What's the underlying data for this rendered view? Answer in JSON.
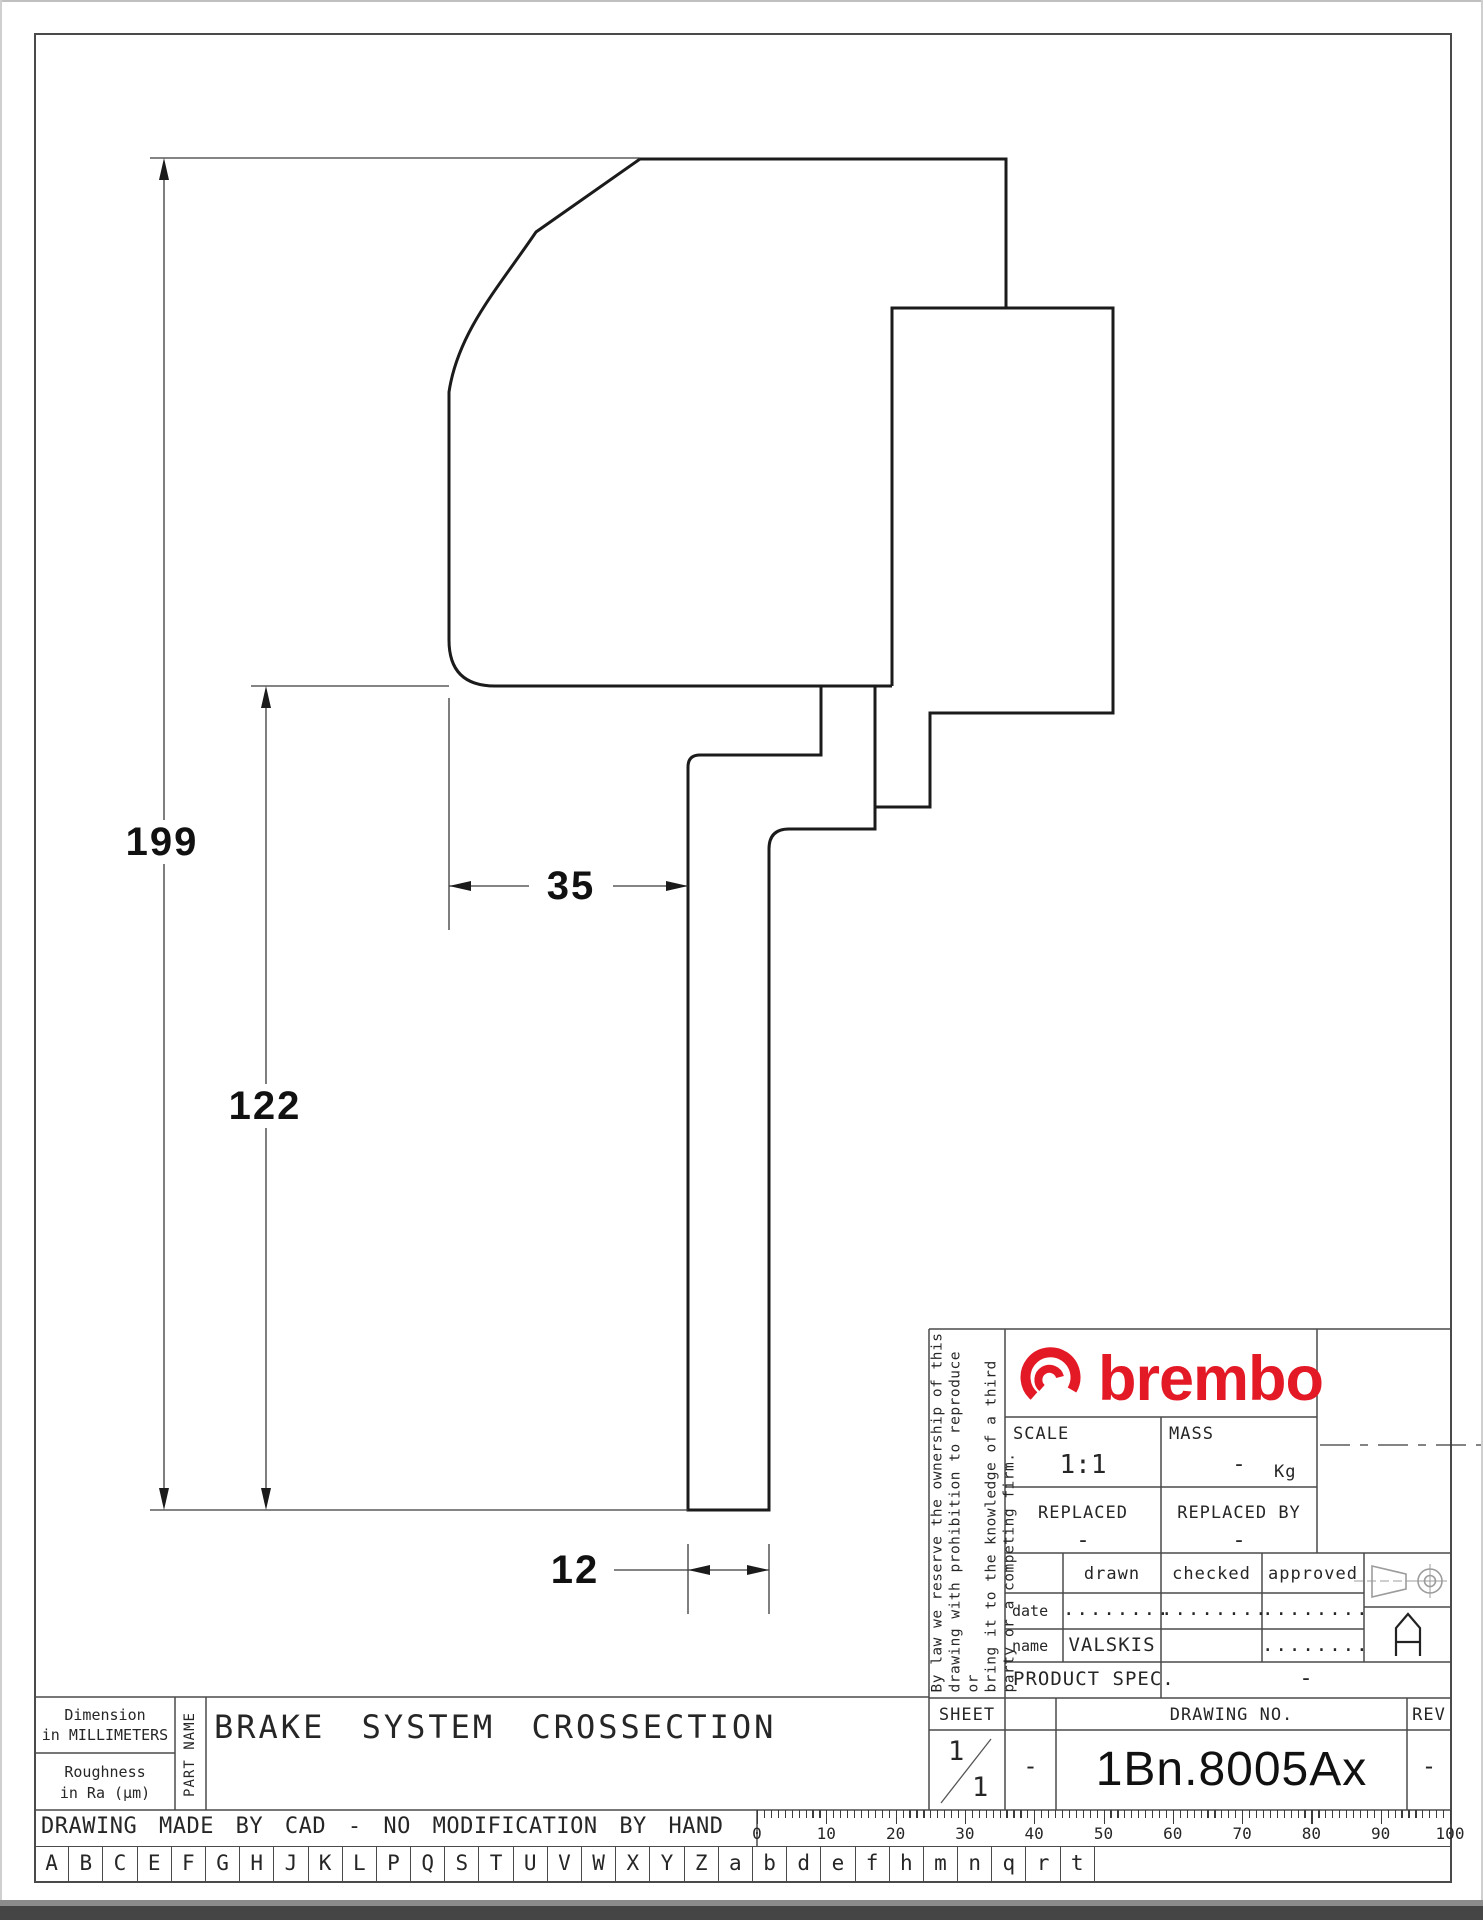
{
  "dimensions": {
    "height_total": "199",
    "height_lower": "122",
    "width_upper": "35",
    "width_stem": "12"
  },
  "title_block": {
    "brand": "brembo",
    "legal_lines": [
      "By law we reserve the ownership of this",
      "drawing with prohibition to reproduce or",
      "bring it to the knowledge of a third",
      "party or a competing firm."
    ],
    "scale_label": "SCALE",
    "scale_value": "1:1",
    "mass_label": "MASS",
    "mass_value": "-",
    "mass_unit": "Kg",
    "replaced_label": "REPLACED",
    "replaced_value": "-",
    "replaced_by_label": "REPLACED BY",
    "replaced_by_value": "-",
    "drawn_label": "drawn",
    "checked_label": "checked",
    "approved_label": "approved",
    "date_label": "date",
    "name_label": "name",
    "date_drawn": "........",
    "date_checked": "........",
    "date_approved": "........",
    "name_drawn": "VALSKIS",
    "name_approved": "........",
    "product_spec_label": "PRODUCT SPEC.",
    "product_spec_value": "-",
    "sheet_label": "SHEET",
    "sheet_num": "1",
    "sheet_total": "1",
    "sheet_dash": "-",
    "drawing_no_label": "DRAWING NO.",
    "drawing_no": "1Bn.8005Ax",
    "rev_label": "REV",
    "rev_value": "-",
    "view_label": "A"
  },
  "footer": {
    "dimension_note_1": "Dimension",
    "dimension_note_2": "in MILLIMETERS",
    "roughness_note_1": "Roughness",
    "roughness_note_2": "in Ra (µm)",
    "part_name_label": "PART NAME",
    "part_name": "BRAKE SYSTEM CROSSECTION",
    "cad_note": "DRAWING MADE BY CAD - NO MODIFICATION BY HAND",
    "ruler_numbers": [
      "0",
      "10",
      "20",
      "30",
      "40",
      "50",
      "60",
      "70",
      "80",
      "90",
      "100"
    ],
    "letters": [
      "A",
      "B",
      "C",
      "E",
      "F",
      "G",
      "H",
      "J",
      "K",
      "L",
      "P",
      "Q",
      "S",
      "T",
      "U",
      "V",
      "W",
      "X",
      "Y",
      "Z",
      "a",
      "b",
      "d",
      "e",
      "f",
      "h",
      "m",
      "n",
      "q",
      "r",
      "t"
    ]
  },
  "colors": {
    "brand_red": "#e31926",
    "line_dark": "#1b1b1b",
    "line_thin": "#3a3a3a",
    "symbol_gray": "#9c9c9c"
  }
}
